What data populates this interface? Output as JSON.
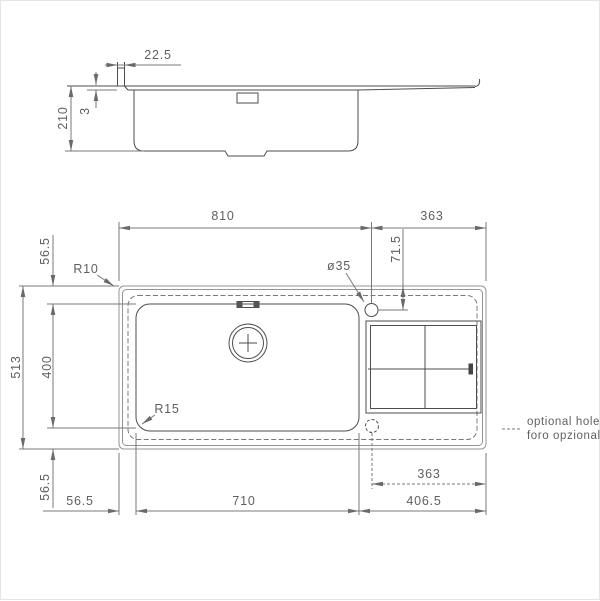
{
  "side_view": {
    "lip_width": "22.5",
    "rim_height": "3",
    "depth": "210"
  },
  "plan_view": {
    "width_left_to_hole": "810",
    "width_hole_to_right": "363",
    "hole_offset_from_top": "71.5",
    "hole_diameter": "ø35",
    "cutout_corner_radius": "R10",
    "bowl_corner_radius": "R15",
    "overall_depth": "513",
    "bowl_front_to_back": "400",
    "top_margin": "56.5",
    "bottom_margin": "56.5",
    "left_margin": "56.5",
    "bowl_width": "710",
    "drainer_section_width": "406.5",
    "optional_hole_to_right_edge": "363"
  },
  "legend": {
    "optional_hole_en": "optional hole",
    "optional_hole_it": "foro opzionale"
  },
  "colors": {
    "feature_line": "#4d4d4d",
    "edge_line": "#949494",
    "dimension_line": "#787878",
    "text": "#5f5f5f",
    "background": "#ffffff"
  }
}
